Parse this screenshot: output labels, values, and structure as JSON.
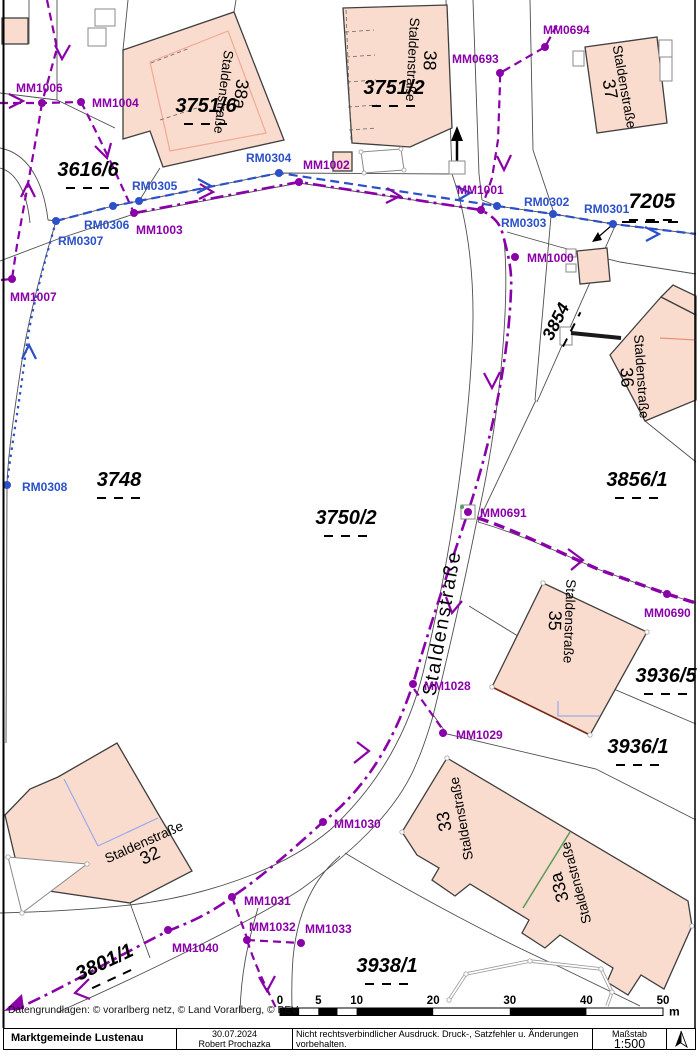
{
  "attribution": "Datengrundlagen: © vorarlberg netz, © Land Vorarlberg, © BEV",
  "footer": {
    "municipality": "Marktgemeinde Lustenau",
    "date": "30.07.2024",
    "author": "Robert Prochazka",
    "disclaimer_line1": "Nicht rechtsverbindlicher Ausdruck. Druck-, Satzfehler u. Änderungen vorbehalten.",
    "disclaimer_line2": "Alle Angaben ohne Gewähr, für Aktualität wird keine Haftung übernommen.",
    "scale_label": "Maßstab",
    "scale_value": "1:500"
  },
  "colors": {
    "mm_purple": "#8A00A8",
    "rm_blue": "#2B50C8",
    "building_fill": "#F9DCCD",
    "building_outline": "#3F3F3F",
    "parcel_line": "#4F4F4F",
    "divider_green": "#5A9A5A",
    "interior_blue": "#9AA8EC",
    "text_black": "#000000"
  },
  "scalebar": {
    "ticks": [
      "0",
      "5",
      "10",
      "20",
      "30",
      "40",
      "50"
    ],
    "tick_meters": [
      0,
      5,
      10,
      20,
      30,
      40,
      50
    ],
    "unit": "m"
  },
  "street_label": {
    "text": "Staldenstraße",
    "x": 448,
    "y": 624,
    "rot": -80
  },
  "parcel_labels": [
    {
      "label": "3751/6",
      "x": 206,
      "y": 112,
      "rot": 0,
      "size": 20
    },
    {
      "label": "3751/2",
      "x": 394,
      "y": 94,
      "rot": 0,
      "size": 20
    },
    {
      "label": "3616/6",
      "x": 88,
      "y": 176,
      "rot": 0,
      "size": 20
    },
    {
      "label": "7205",
      "x": 652,
      "y": 208,
      "rot": 0,
      "size": 21
    },
    {
      "label": "3854",
      "x": 561,
      "y": 324,
      "rot": -63,
      "size": 17.5
    },
    {
      "label": "3748",
      "x": 119,
      "y": 486,
      "rot": 0,
      "size": 20
    },
    {
      "label": "3750/2",
      "x": 346,
      "y": 524,
      "rot": 0,
      "size": 20
    },
    {
      "label": "3856/1",
      "x": 637,
      "y": 486,
      "rot": 0,
      "size": 20
    },
    {
      "label": "3936/5",
      "x": 666,
      "y": 682,
      "rot": 0,
      "size": 20
    },
    {
      "label": "3936/1",
      "x": 638,
      "y": 753,
      "rot": 0,
      "size": 20
    },
    {
      "label": "3938/1",
      "x": 387,
      "y": 972,
      "rot": 0,
      "size": 20
    },
    {
      "label": "3801/1",
      "x": 107,
      "y": 968,
      "rot": -25,
      "size": 20
    }
  ],
  "building_labels": [
    {
      "street": "Staldenstraße",
      "number": "38a",
      "x": 232,
      "y": 93,
      "rot": 97,
      "number_first": true
    },
    {
      "street": "Staldenstraße",
      "number": "38",
      "x": 421,
      "y": 60,
      "rot": 93,
      "number_first": true
    },
    {
      "street": "Staldenstraße",
      "number": "37",
      "x": 617,
      "y": 88,
      "rot": 80,
      "number_first": false
    },
    {
      "street": "Staldenstraße",
      "number": "36",
      "x": 634,
      "y": 377,
      "rot": 86,
      "number_first": false
    },
    {
      "street": "Staldenstraße",
      "number": "35",
      "x": 562,
      "y": 621,
      "rot": 92,
      "number_first": false
    },
    {
      "street": "Staldenstraße",
      "number": "33",
      "x": 453,
      "y": 820,
      "rot": -100,
      "number_first": true
    },
    {
      "street": "Staldenstraße",
      "number": "33a",
      "x": 568,
      "y": 885,
      "rot": -105,
      "number_first": true
    },
    {
      "street": "Staldenstraße",
      "number": "32",
      "x": 147,
      "y": 849,
      "rot": -24,
      "number_first": false
    }
  ],
  "survey_points": [
    {
      "id": "MM1006",
      "kind": "MM",
      "x": 42,
      "y": 103,
      "lx": 16,
      "ly": 92
    },
    {
      "id": "MM1004",
      "kind": "MM",
      "x": 81,
      "y": 102,
      "lx": 92,
      "ly": 107
    },
    {
      "id": "MM1003",
      "kind": "MM",
      "x": 134,
      "y": 213,
      "lx": 136,
      "ly": 234
    },
    {
      "id": "MM1002",
      "kind": "MM",
      "x": 299,
      "y": 182,
      "lx": 303,
      "ly": 169
    },
    {
      "id": "MM1001",
      "kind": "MM",
      "x": 481,
      "y": 210,
      "lx": 457,
      "ly": 194
    },
    {
      "id": "MM1000",
      "kind": "MM",
      "x": 515,
      "y": 257,
      "lx": 527,
      "ly": 262
    },
    {
      "id": "MM1007",
      "kind": "MM",
      "x": 12,
      "y": 279,
      "lx": 10,
      "ly": 301
    },
    {
      "id": "MM0693",
      "kind": "MM",
      "x": 500,
      "y": 73,
      "lx": 452,
      "ly": 63
    },
    {
      "id": "MM0694",
      "kind": "MM",
      "x": 545,
      "y": 47,
      "lx": 543,
      "ly": 34
    },
    {
      "id": "MM0691",
      "kind": "MM",
      "x": 468,
      "y": 512,
      "lx": 480,
      "ly": 517,
      "marker": "square"
    },
    {
      "id": "MM0690",
      "kind": "MM",
      "x": 667,
      "y": 594,
      "lx": 644,
      "ly": 617
    },
    {
      "id": "MM1028",
      "kind": "MM",
      "x": 413,
      "y": 684,
      "lx": 424,
      "ly": 690
    },
    {
      "id": "MM1029",
      "kind": "MM",
      "x": 443,
      "y": 733,
      "lx": 456,
      "ly": 739
    },
    {
      "id": "MM1030",
      "kind": "MM",
      "x": 323,
      "y": 822,
      "lx": 334,
      "ly": 828
    },
    {
      "id": "MM1031",
      "kind": "MM",
      "x": 232,
      "y": 897,
      "lx": 244,
      "ly": 905
    },
    {
      "id": "MM1032",
      "kind": "MM",
      "x": 247,
      "y": 940,
      "lx": 249,
      "ly": 931
    },
    {
      "id": "MM1033",
      "kind": "MM",
      "x": 301,
      "y": 943,
      "lx": 305,
      "ly": 933
    },
    {
      "id": "MM1040",
      "kind": "MM",
      "x": 168,
      "y": 930,
      "lx": 172,
      "ly": 952
    },
    {
      "id": "RM0304",
      "kind": "RM",
      "x": 279,
      "y": 173,
      "lx": 246,
      "ly": 162
    },
    {
      "id": "RM0305",
      "kind": "RM",
      "x": 139,
      "y": 201,
      "lx": 132,
      "ly": 190
    },
    {
      "id": "RM0306",
      "kind": "RM",
      "x": 113,
      "y": 206,
      "lx": 84,
      "ly": 229
    },
    {
      "id": "RM0307",
      "kind": "RM",
      "x": 56,
      "y": 221,
      "lx": 58,
      "ly": 245
    },
    {
      "id": "RM0303",
      "kind": "RM",
      "x": 497,
      "y": 206,
      "lx": 501,
      "ly": 227
    },
    {
      "id": "RM0302",
      "kind": "RM",
      "x": 553,
      "y": 214,
      "lx": 524,
      "ly": 206
    },
    {
      "id": "RM0301",
      "kind": "RM",
      "x": 613,
      "y": 224,
      "lx": 584,
      "ly": 213
    },
    {
      "id": "RM0308",
      "kind": "RM",
      "x": 7,
      "y": 485,
      "lx": 22,
      "ly": 491
    }
  ]
}
